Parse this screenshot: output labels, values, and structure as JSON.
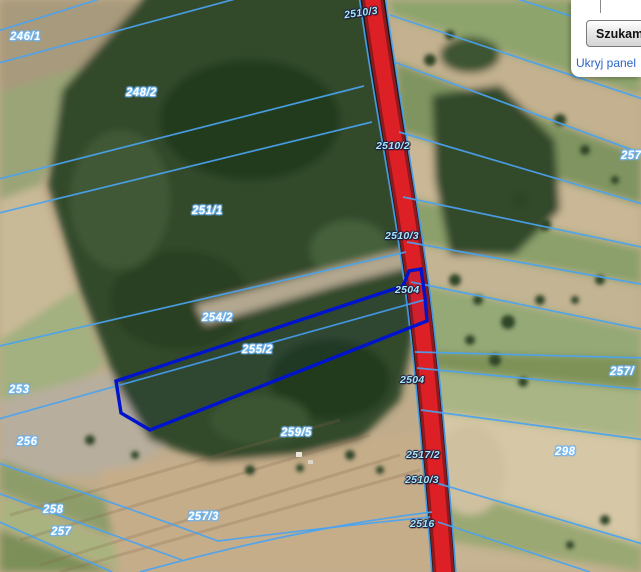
{
  "panel": {
    "search_button_label": "Szukam",
    "hide_panel_link_label": "Ukryj panel"
  },
  "map": {
    "parcel_labels": [
      {
        "text": "246/1"
      },
      {
        "text": "248/2"
      },
      {
        "text": "251/1"
      },
      {
        "text": "254/2"
      },
      {
        "text": "255/2"
      },
      {
        "text": "253"
      },
      {
        "text": "256"
      },
      {
        "text": "259/5"
      },
      {
        "text": "258"
      },
      {
        "text": "257"
      },
      {
        "text": "257/3"
      },
      {
        "text": "298"
      },
      {
        "text": "257/"
      },
      {
        "text": "257"
      }
    ],
    "road_labels": [
      {
        "text": "2510/3"
      },
      {
        "text": "2510/2"
      },
      {
        "text": "2510/3"
      },
      {
        "text": "2504"
      },
      {
        "text": "2504"
      },
      {
        "text": "2517/2"
      },
      {
        "text": "2510/3"
      },
      {
        "text": "2516"
      }
    ],
    "colors": {
      "cadastral_line": "#4aa3f0",
      "selected_parcel_outline": "#0013cd",
      "road_fill": "#dc2026",
      "parcel_label_text": "#ffffff",
      "road_label_text": "#a9e6f2",
      "hide_panel_link": "#2a66c8"
    }
  }
}
